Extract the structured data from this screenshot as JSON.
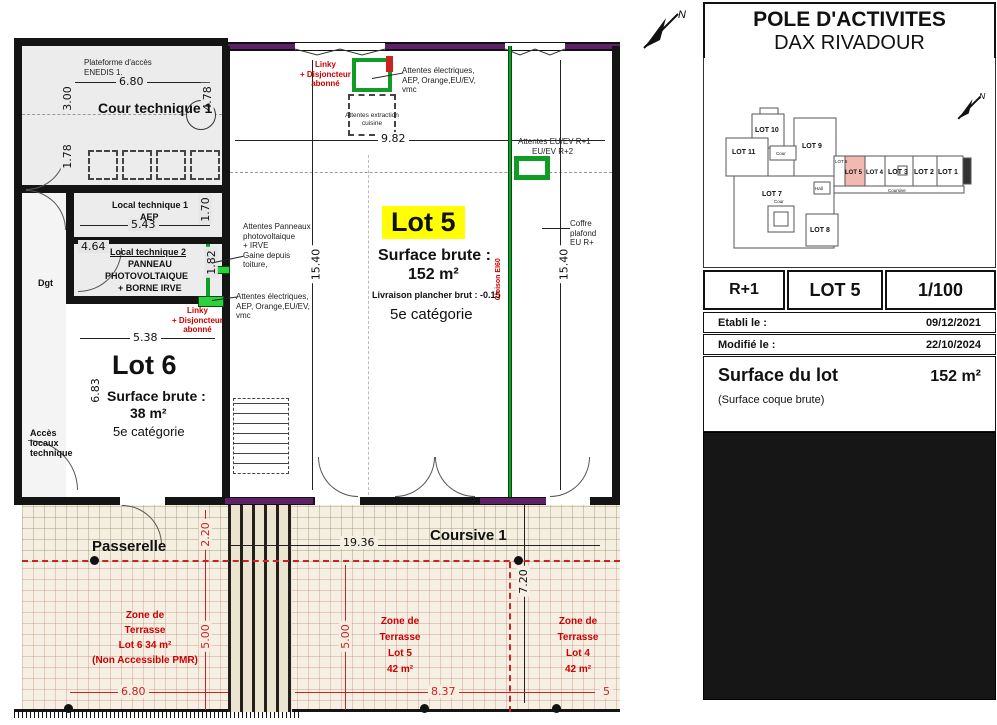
{
  "misc": {
    "north": "N"
  },
  "colors": {
    "wall_purple": "#5e2168",
    "attente_green": "#0f9d26",
    "annotation_red": "#cc0000",
    "lot5_highlight_yellow": "#ffff00",
    "keyplan_lot5_pink": "#f2b9b2",
    "terrace_red": "#cc2222"
  },
  "plan": {
    "rooms": {
      "plateforme1": "Plateforme d'accès",
      "plateforme2": "ENEDIS 1.",
      "cour_technique": "Cour technique 1",
      "local1a": "Local technique 1",
      "local1b": "AEP",
      "local2": "Local technique 2",
      "pv1": "PANNEAU",
      "pv2": "PHOTOVOLTAIQUE",
      "pv3": "+ BORNE IRVE",
      "dgt": "Dgt",
      "acces1": "Accès",
      "acces2": "locaux",
      "acces3": "technique",
      "lot6_title": "Lot 6",
      "lot6_sb": "Surface brute :",
      "lot6_area": "38 m²",
      "lot6_cat": "5e catégorie",
      "lot5_title": "Lot 5",
      "lot5_sb": "Surface brute :",
      "lot5_area": "152 m²",
      "lot5_liv": "Livraison plancher brut : -0.15",
      "lot5_cat": "5e catégorie",
      "passerelle": "Passerelle",
      "coursive": "Coursive 1"
    },
    "ann": {
      "linky": [
        "Linky",
        "+ Disjoncteur",
        "abonné"
      ],
      "elec": [
        "Attentes électriques,",
        "AEP, Orange,EU/EV,",
        "vmc"
      ],
      "extraction": [
        "Attentes extraction",
        "cuisine"
      ],
      "euev": [
        "Attentes EU/EV R+1",
        "EU/EV R+2"
      ],
      "coffre": [
        "Coffre",
        "plafond",
        "EU  R+"
      ],
      "pv": [
        "Attentes Panneaux",
        "photovoltaique",
        "+ IRVE",
        "Gaine depuis",
        "toiture,"
      ],
      "cloison": "Cloison EI60"
    },
    "terr": {
      "t6": [
        "Zone de",
        "Terrasse",
        "Lot 6    34 m²",
        "(Non Accessible PMR)"
      ],
      "t5": [
        "Zone de",
        "Terrasse",
        "Lot 5",
        "42 m²"
      ],
      "t4": [
        "Zone de",
        "Terrasse",
        "Lot 4",
        "42 m²"
      ]
    },
    "dims": {
      "a680": "6.80",
      "a300": "3.00",
      "a478": "4.78",
      "a178": "1.78",
      "a543": "5.43",
      "a170": "1.70",
      "a464": "4.64",
      "a182": "1.82",
      "a538": "5.38",
      "a683": "6.83",
      "a982": "9.82",
      "a1540": "15.40",
      "b1540": "15.40",
      "a1936": "19.36",
      "a220": "2.20",
      "a500": "5.00",
      "b500": "5.00",
      "a720": "7.20",
      "b680": "6.80",
      "a837": "8.37",
      "a5": "5"
    }
  },
  "panel": {
    "title1": "POLE D'ACTIVITES",
    "title2": "DAX RIVADOUR",
    "level": "R+1",
    "lot": "LOT 5",
    "scale": "1/100",
    "etabli_label": "Etabli le :",
    "etabli": "09/12/2021",
    "modifie_label": "Modifié le :",
    "modifie": "22/10/2024",
    "surface_label": "Surface du lot",
    "surface_value": "152  m²",
    "surface_note": "(Surface coque brute)"
  },
  "keyplan": {
    "lot1": "LOT 1",
    "lot2": "LOT 2",
    "lot3": "LOT 3",
    "lot4": "LOT 4",
    "lot5": "LOT 5",
    "lot6": "LOT 6",
    "lot7": "LOT 7",
    "lot8": "LOT 8",
    "lot9": "LOT 9",
    "lot10": "LOT 10",
    "lot11": "LOT 11",
    "cour1": "Cour",
    "cour2": "Cour",
    "hall": "Hall",
    "coursive": "Coursive"
  }
}
